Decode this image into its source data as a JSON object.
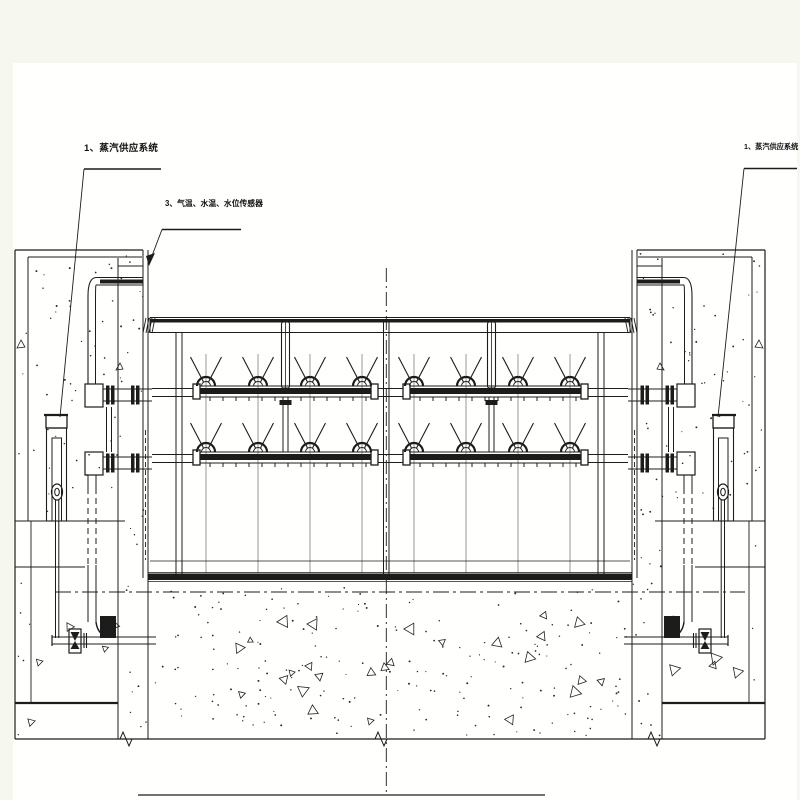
{
  "labels": {
    "steam_supply_left": {
      "text": "1、蒸汽供应系统"
    },
    "sensors": {
      "text": "3、气温、水温、水位传感器"
    },
    "steam_supply_right": {
      "text": "1、蒸汽供应系统"
    }
  },
  "colors": {
    "background": "#f6f8ef",
    "paper": "#fffffd",
    "line": "#1c1c1c",
    "faint_line": "#555555"
  }
}
